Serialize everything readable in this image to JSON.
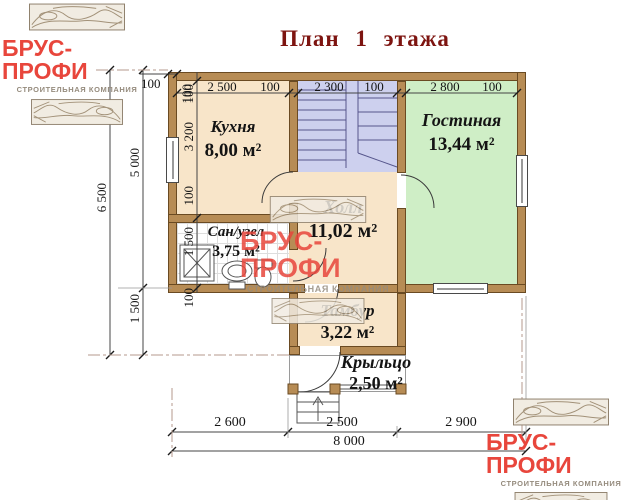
{
  "title": "План 1 этажа",
  "logo": {
    "name": "БРУС-ПРОФИ",
    "subtitle": "СТРОИТЕЛЬНАЯ КОМПАНИЯ"
  },
  "rooms": {
    "kitchen": {
      "name": "Кухня",
      "area": "8,00 м²"
    },
    "living": {
      "name": "Гостиная",
      "area": "13,44 м²"
    },
    "hall": {
      "name": "Холл",
      "area": "11,02 м²"
    },
    "bath": {
      "name": "Сан/узел",
      "area": "3,75 м²"
    },
    "tambur": {
      "name": "Тамбур",
      "area": "3,22 м²"
    },
    "porch": {
      "name": "Крыльцо",
      "area": "2,50 м²"
    }
  },
  "dims": {
    "top_wall": "100",
    "top": [
      "100",
      "2 500",
      "100",
      "2 300",
      "100",
      "2 800",
      "100"
    ],
    "left_total": "6 500",
    "left_upper": "5 000",
    "left_lower": "1 500",
    "left_inner": [
      "100",
      "3 200",
      "100",
      "1 500",
      "100"
    ],
    "bottom": [
      "2 600",
      "2 500",
      "2 900"
    ],
    "bottom_total": "8 000"
  },
  "colors": {
    "accent_red": "#e8463c",
    "title_red": "#7d1410",
    "wall_brown": "#b78c55",
    "room_warm": "#f8e5c9",
    "room_living": "#cfeec6",
    "room_stairs": "#cdd0ee"
  }
}
